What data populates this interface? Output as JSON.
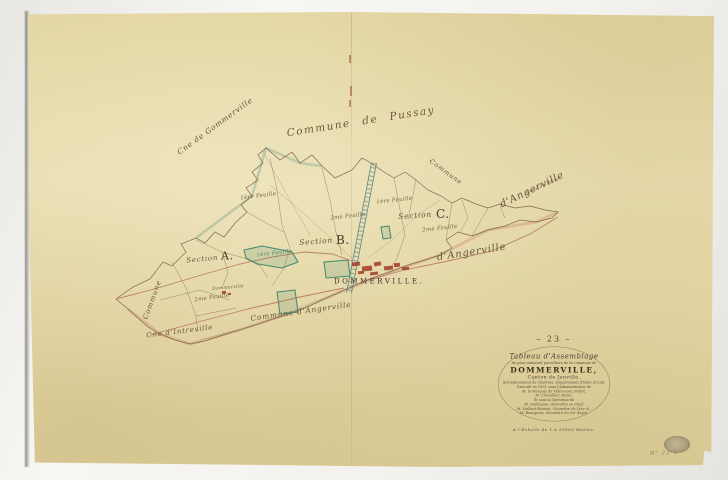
{
  "colors": {
    "paper": "#e6d9a8",
    "boundary": "#7d6c4b",
    "road": "#b4705a",
    "national_road": "#4f7f85",
    "parcel_green": "#3e8a6c",
    "village_red": "#a23a26",
    "ink": "#4a4236"
  },
  "map": {
    "village_label": "DOMMERVILLE.",
    "labels": [
      {
        "text": "Commune de Pussay",
        "x": 286,
        "y": 128,
        "rot": -9,
        "size": 10.5,
        "cls": "script spread"
      },
      {
        "text": "Cne de Gommerville",
        "x": 176,
        "y": 150,
        "rot": -36,
        "size": 7.5,
        "cls": "script"
      },
      {
        "text": "Commune",
        "x": 142,
        "y": 318,
        "rot": -70,
        "size": 7,
        "cls": "script"
      },
      {
        "text": "Cne d'Intreville",
        "x": 146,
        "y": 332,
        "rot": -7,
        "size": 7,
        "cls": "script"
      },
      {
        "text": "Commune d'Angerville",
        "x": 250,
        "y": 315,
        "rot": -8,
        "size": 7.5,
        "cls": "script"
      },
      {
        "text": "d'Angerville",
        "x": 436,
        "y": 252,
        "rot": -9,
        "size": 10,
        "cls": "script"
      },
      {
        "text": "d'Angerville",
        "x": 498,
        "y": 200,
        "rot": -26,
        "size": 10,
        "cls": "script"
      },
      {
        "text": "Route de Paris",
        "x": 524,
        "y": 192,
        "rot": -24,
        "size": 4.5,
        "cls": "feuille"
      },
      {
        "text": "Commune",
        "x": 432,
        "y": 158,
        "rot": 36,
        "size": 6.5,
        "cls": "script"
      },
      {
        "text": "Section",
        "x": 186,
        "y": 257,
        "rot": -5,
        "size": 7,
        "cls": "script"
      },
      {
        "text": "A.",
        "x": 221,
        "y": 251,
        "rot": 0,
        "size": 11,
        "cls": "letter"
      },
      {
        "text": "Section",
        "x": 299,
        "y": 239,
        "rot": -4,
        "size": 7.5,
        "cls": "script"
      },
      {
        "text": "B.",
        "x": 336,
        "y": 234,
        "rot": 0,
        "size": 12,
        "cls": "letter"
      },
      {
        "text": "Section",
        "x": 398,
        "y": 213,
        "rot": -4,
        "size": 7.5,
        "cls": "script"
      },
      {
        "text": "C.",
        "x": 436,
        "y": 208,
        "rot": 0,
        "size": 12,
        "cls": "letter"
      },
      {
        "text": "1ère Feuille",
        "x": 240,
        "y": 195,
        "rot": -7,
        "size": 5.5,
        "cls": "feuille"
      },
      {
        "text": "1ère Feuille",
        "x": 376,
        "y": 199,
        "rot": -6,
        "size": 5.5,
        "cls": "feuille"
      },
      {
        "text": "2me Feuille",
        "x": 330,
        "y": 215,
        "rot": -6,
        "size": 5.5,
        "cls": "feuille"
      },
      {
        "text": "2me Feuille",
        "x": 422,
        "y": 227,
        "rot": -6,
        "size": 5.5,
        "cls": "feuille"
      },
      {
        "text": "1ère Feuille",
        "x": 256,
        "y": 252,
        "rot": -6,
        "size": 5.5,
        "cls": "feuille-green"
      },
      {
        "text": "Dommerville",
        "x": 212,
        "y": 287,
        "rot": -5,
        "size": 4.5,
        "cls": "feuille"
      },
      {
        "text": "2me Feuille",
        "x": 194,
        "y": 297,
        "rot": -8,
        "size": 5.5,
        "cls": "feuille"
      },
      {
        "text": "DOMMERVILLE.",
        "x": 334,
        "y": 278,
        "rot": 0,
        "size": 7,
        "cls": "caps"
      }
    ]
  },
  "cartouche": {
    "number": "– 23 –",
    "title_script": "Tableau d'Assemblage",
    "subtitle": "du plan cadastral parcellaire de la commune de",
    "commune": "DOMMERVILLE,",
    "canton": "Canton de Janville.",
    "admin_lines": [
      {
        "text": "Arrondissement de Chartres, Département d'Eure et Loir.",
        "it": false
      },
      {
        "text": "Exécuté en 1831 sous l'Administration de",
        "it": false
      },
      {
        "text": "M. le Marquis de Villeneuve, Préfet,",
        "it": true
      },
      {
        "text": "M. Chevallier, Maire.",
        "it": true
      },
      {
        "text": "Et sous la Direction de",
        "it": false
      },
      {
        "text": "M. Guillaume, Géomètre en Chef,",
        "it": true
      },
      {
        "text": "M. Vaillant-Benoist, Géomètre de 1ère cl.,",
        "it": true
      },
      {
        "text": "M. Bourgeois, Géomètre du 1er degré.",
        "it": true
      }
    ],
    "scale": "A l'Echelle de 1 à 10000 Mètres."
  },
  "stamp": {
    "number": "N° 23-1"
  }
}
